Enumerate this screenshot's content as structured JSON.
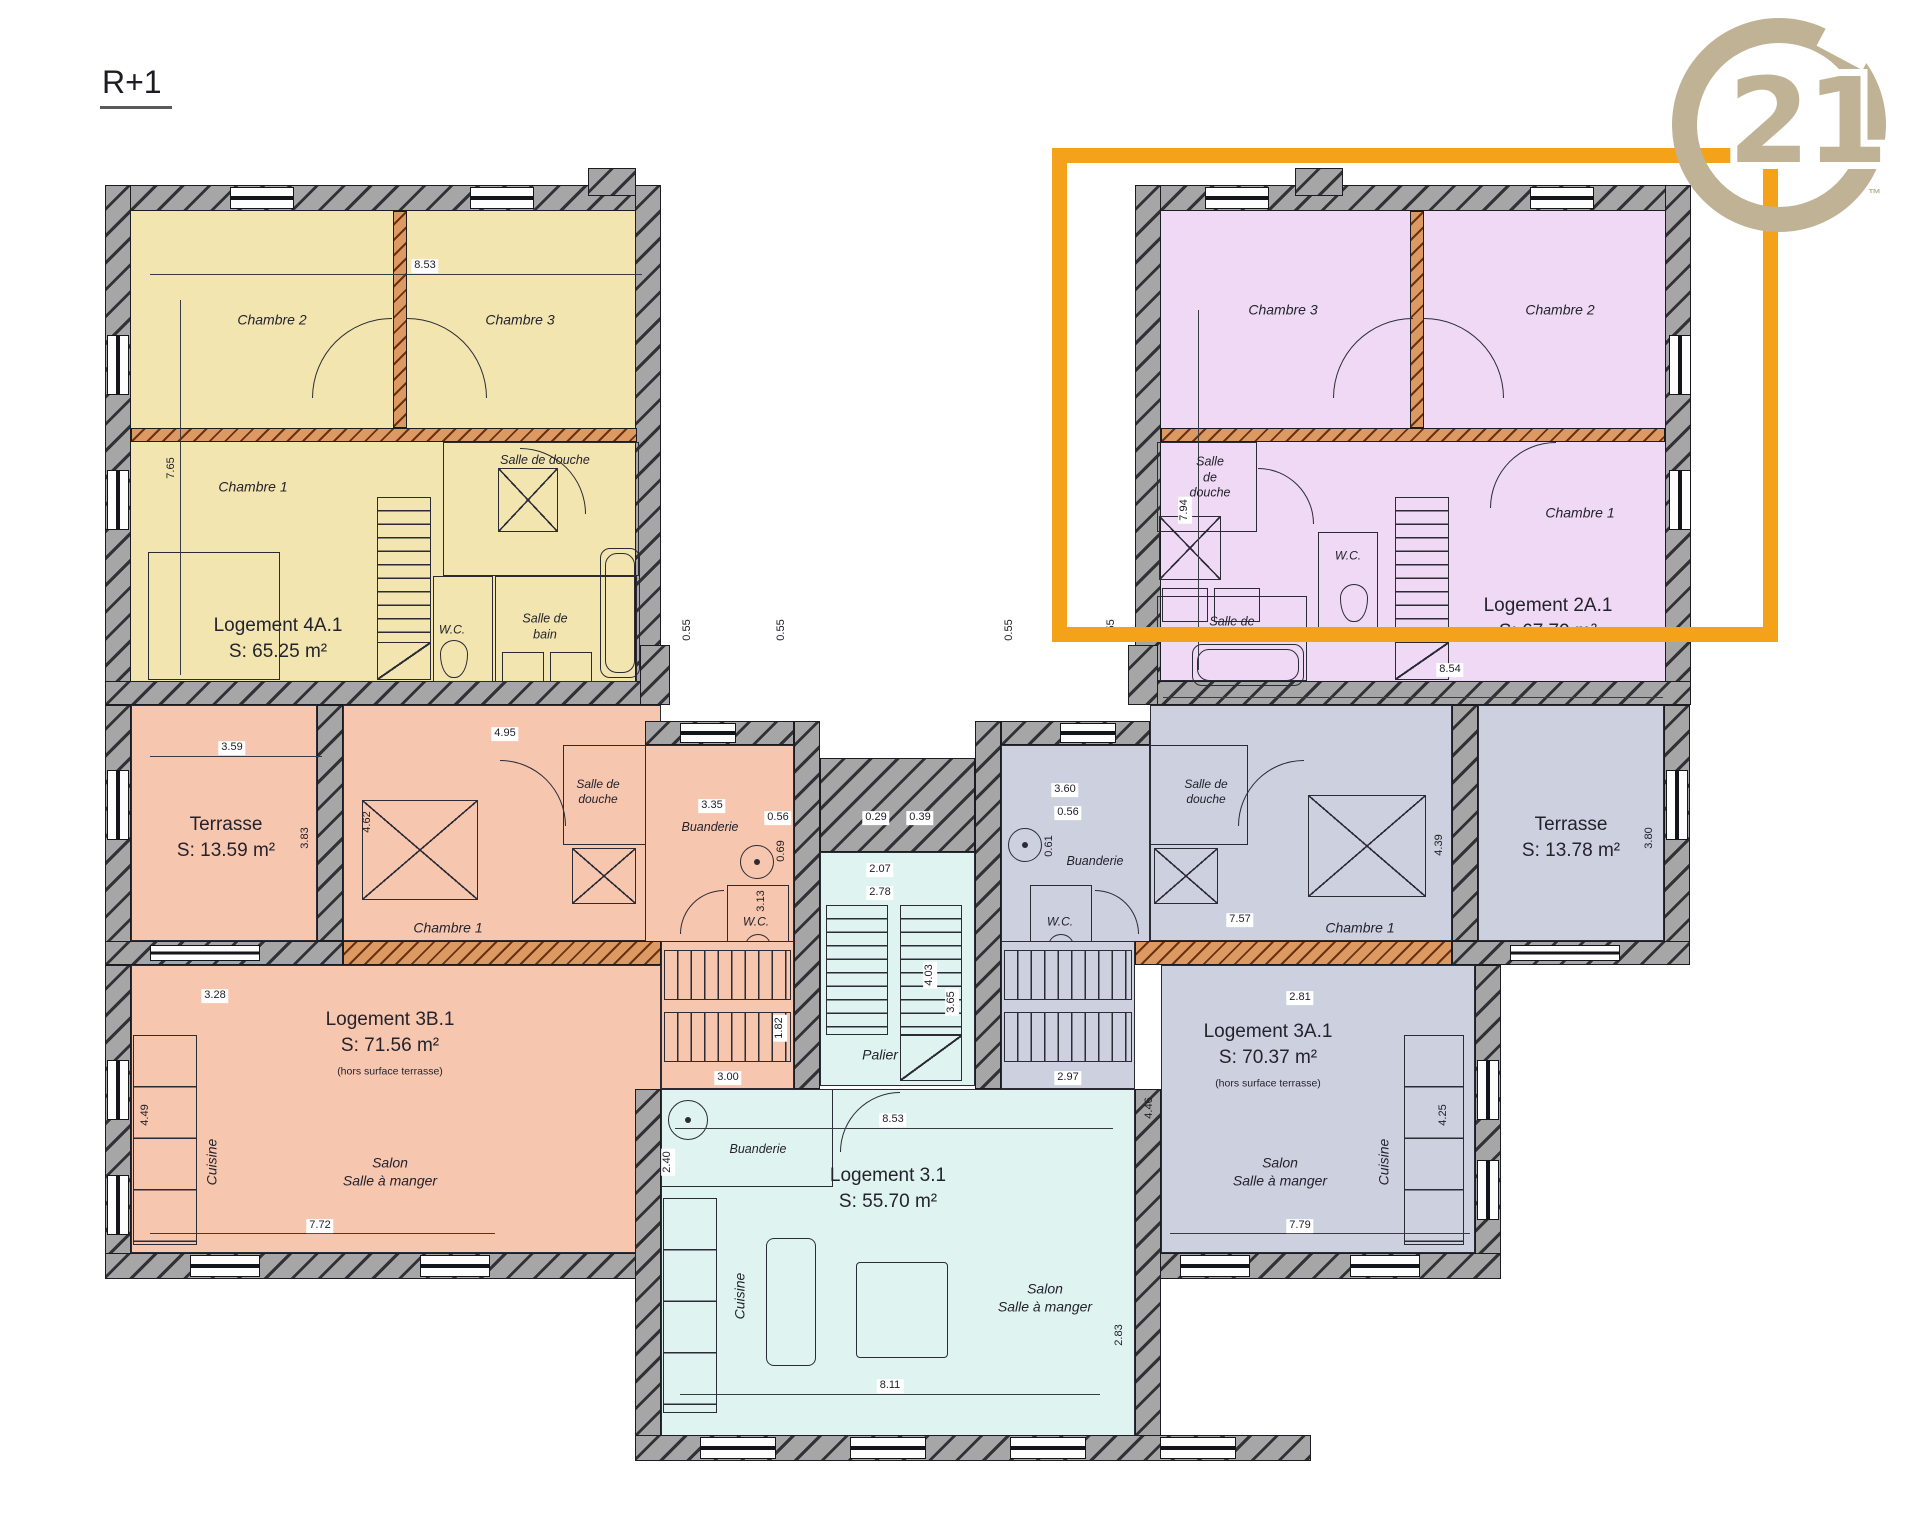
{
  "floor_label": "R+1",
  "brand": {
    "name": "Century 21",
    "big": "21",
    "tm": "™"
  },
  "colors": {
    "highlight_box": "#F5A21B",
    "brand_gold": "#BFB295",
    "wall_grey": "#969696",
    "partition_orange": "#D08040",
    "logement_4a1_fill": "#F3E5B0",
    "logement_2a1_fill": "#EFD9F4",
    "logement_3b1_fill": "#F7C6AF",
    "logement_3a1_fill": "#CDD0DF",
    "logement_31_fill": "#DFF3F0"
  },
  "l4": {
    "title": "Logement 4A.1",
    "area": "S: 65.25 m²",
    "chambre1": "Chambre 1",
    "chambre2": "Chambre 2",
    "chambre3": "Chambre 3",
    "sdd": "Salle de douche",
    "sdb": "Salle de\nbain",
    "wc": "W.C.",
    "dim_top": "8.53",
    "dim_left": "7.65"
  },
  "l2": {
    "title": "Logement 2A.1",
    "area": "S: 67.79 m²",
    "chambre1": "Chambre 1",
    "chambre2": "Chambre 2",
    "chambre3": "Chambre 3",
    "sdd": "Salle\nde\ndouche",
    "sdb": "Salle de\nbain",
    "wc": "W.C.",
    "dim_left": "7.94",
    "dim_bottom": "8.54"
  },
  "tl": {
    "title": "Terrasse",
    "area": "S: 13.59 m²",
    "dim_top": "3.59",
    "dim_right": "3.83"
  },
  "tr": {
    "title": "Terrasse",
    "area": "S: 13.78 m²",
    "dim_right": "3.80"
  },
  "l3b": {
    "title": "Logement 3B.1",
    "area": "S: 71.56 m²",
    "note": "(hors surface terrasse)",
    "chambre1": "Chambre 1",
    "sdd": "Salle de\ndouche",
    "buanderie": "Buanderie",
    "wc": "W.C.",
    "salon": "Salon\nSalle à manger",
    "cuisine": "Cuisine",
    "dims": {
      "d495": "4.95",
      "d462": "4.62",
      "d335": "3.35",
      "d056": "0.56",
      "d069": "0.69",
      "d313": "3.13",
      "d328": "3.28",
      "d449": "4.49",
      "d772": "7.72",
      "d182": "1.82",
      "d300": "3.00"
    }
  },
  "l3a": {
    "title": "Logement 3A.1",
    "area": "S: 70.37 m²",
    "note": "(hors surface terrasse)",
    "chambre1": "Chambre 1",
    "sdd": "Salle de\ndouche",
    "buanderie": "Buanderie",
    "wc": "W.C.",
    "salon": "Salon\nSalle à manger",
    "cuisine": "Cuisine",
    "dims": {
      "d360": "3.60",
      "d056": "0.56",
      "d061": "0.61",
      "d757": "7.57",
      "d439": "4.39",
      "d281": "2.81",
      "d446": "4.46",
      "d779": "7.79",
      "d425": "4.25",
      "d297": "2.97"
    }
  },
  "l31": {
    "title": "Logement 3.1",
    "area": "S: 55.70 m²",
    "buanderie": "Buanderie",
    "cuisine": "Cuisine",
    "salon": "Salon\nSalle à manger",
    "dims": {
      "d240": "2.40",
      "d853": "8.53",
      "d811": "8.11",
      "d283": "2.83"
    }
  },
  "palier": {
    "label": "Palier",
    "dims": {
      "d207": "2.07",
      "d278": "2.78",
      "d403": "4.03",
      "d365": "3.65",
      "d029": "0.29",
      "d039": "0.39"
    }
  },
  "corridor": {
    "d055_1": "0.55",
    "d055_2": "0.55",
    "d055_3": "0.55",
    "d055_4": "0.55"
  }
}
